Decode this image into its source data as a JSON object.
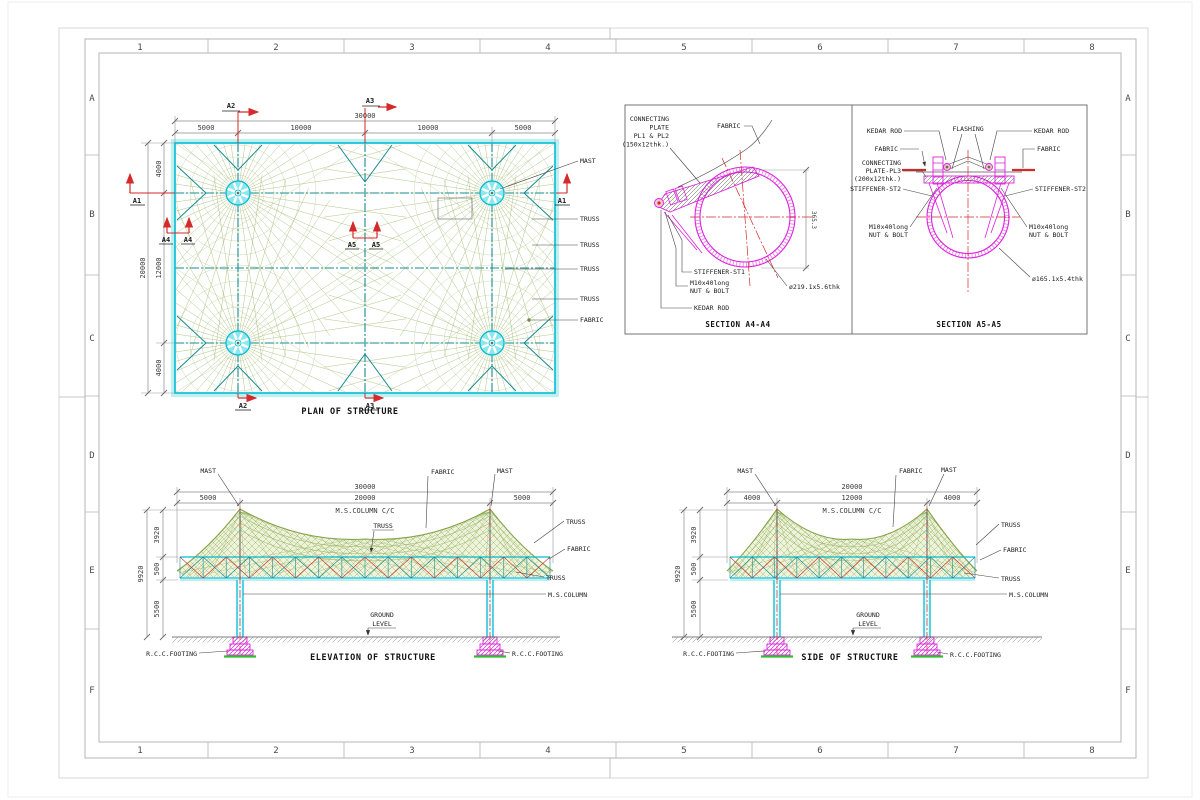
{
  "sheet": {
    "grid_cols": [
      "1",
      "2",
      "3",
      "4",
      "5",
      "6",
      "7",
      "8"
    ],
    "grid_rows": [
      "A",
      "B",
      "C",
      "D",
      "E",
      "F"
    ]
  },
  "labels": {
    "mast": "MAST",
    "truss": "TRUSS",
    "fabric": "FABRIC",
    "ms_column": "M.S.COLUMN",
    "ms_column_cc": "M.S.COLUMN C/C",
    "ground_line1": "GROUND",
    "ground_line2": "LEVEL",
    "rcc_footing": "R.C.C.FOOTING",
    "kedar_rod": "KEDAR ROD",
    "flashing": "FLASHING",
    "bolt_line1": "M10x40long",
    "bolt_line2": "NUT & BOLT"
  },
  "plan": {
    "title": "PLAN OF STRUCTURE",
    "dim_overall_w": "30000",
    "dim_w": [
      "5000",
      "10000",
      "10000",
      "5000"
    ],
    "dim_overall_h": "20000",
    "dim_h": [
      "4000",
      "12000",
      "4000"
    ],
    "markers": {
      "a1": "A1",
      "a2": "A2",
      "a3": "A3",
      "a4": "A4",
      "a5": "A5"
    }
  },
  "elevation": {
    "title": "ELEVATION OF STRUCTURE",
    "dim_overall_w": "30000",
    "dim_w": [
      "5000",
      "20000",
      "5000"
    ],
    "dim_overall_h": "9920",
    "dim_h": [
      "3920",
      "500",
      "5500"
    ]
  },
  "side": {
    "title": "SIDE OF STRUCTURE",
    "dim_overall_w": "20000",
    "dim_w": [
      "4000",
      "12000",
      "4000"
    ],
    "dim_overall_h": "9920",
    "dim_h": [
      "3920",
      "500",
      "5500"
    ]
  },
  "section_a4": {
    "title": "SECTION A4-A4",
    "plate": [
      "CONNECTING",
      "PLATE",
      "PL1 & PL2",
      "(150x12thk.)"
    ],
    "stiffener": "STIFFENER-ST1",
    "pipe": "ø219.1x5.6thk",
    "vdim": "365.3"
  },
  "section_a5": {
    "title": "SECTION A5-A5",
    "plate": [
      "CONNECTING",
      "PLATE-PL3",
      "(200x12thk.)"
    ],
    "stiffener": "STIFFENER-ST2",
    "pipe": "ø165.1x5.4thk"
  },
  "colors": {
    "cyan": "#00bcd2",
    "cyan_fill": "#9feef4",
    "teal": "#168b95",
    "olive": "#9bb463",
    "olive_dk": "#86a44a",
    "red": "#d42a2a",
    "magenta": "#dd22dd",
    "green": "#2fbf2f",
    "dimline": "#8a8a8a",
    "leader": "#444444"
  }
}
